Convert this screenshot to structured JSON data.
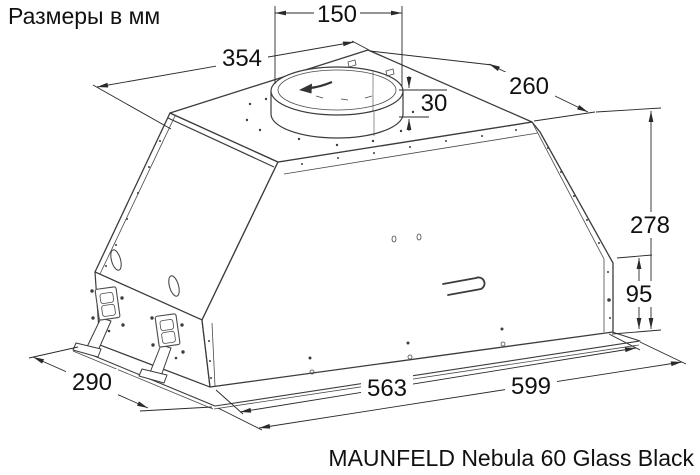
{
  "title": "Размеры в мм",
  "product_caption": "MAUNFELD Nebula 60 Glass Black",
  "dimensions_mm": {
    "duct_opening_width": "150",
    "top_panel_length": "354",
    "top_panel_depth": "260",
    "duct_collar_height": "30",
    "total_height": "278",
    "lower_section_height": "95",
    "body_bottom_width": "563",
    "flange_width": "599",
    "flange_depth": "290"
  }
}
